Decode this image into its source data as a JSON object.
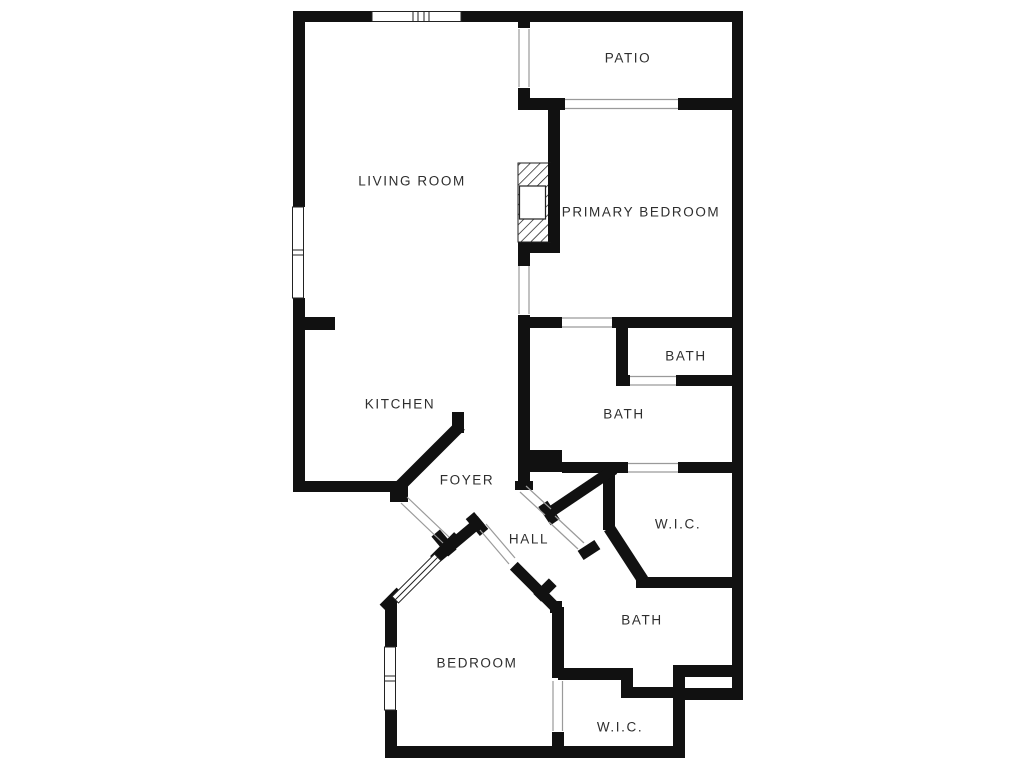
{
  "floorplan": {
    "rooms": {
      "living_room": {
        "label": "LIVING ROOM"
      },
      "patio": {
        "label": "PATIO"
      },
      "primary_bedroom": {
        "label": "PRIMARY BEDROOM"
      },
      "bath_small": {
        "label": "BATH"
      },
      "bath_primary": {
        "label": "BATH"
      },
      "kitchen": {
        "label": "KITCHEN"
      },
      "foyer": {
        "label": "FOYER"
      },
      "hall": {
        "label": "HALL"
      },
      "wic_top": {
        "label": "W.I.C."
      },
      "bath_lower": {
        "label": "BATH"
      },
      "bedroom": {
        "label": "BEDROOM"
      },
      "wic_bottom": {
        "label": "W.I.C."
      }
    },
    "colors": {
      "wall": "#111111",
      "background": "#ffffff",
      "opening_line": "#9a9a9a",
      "window_stroke": "#222222",
      "label_text": "#2e2e2e"
    }
  }
}
